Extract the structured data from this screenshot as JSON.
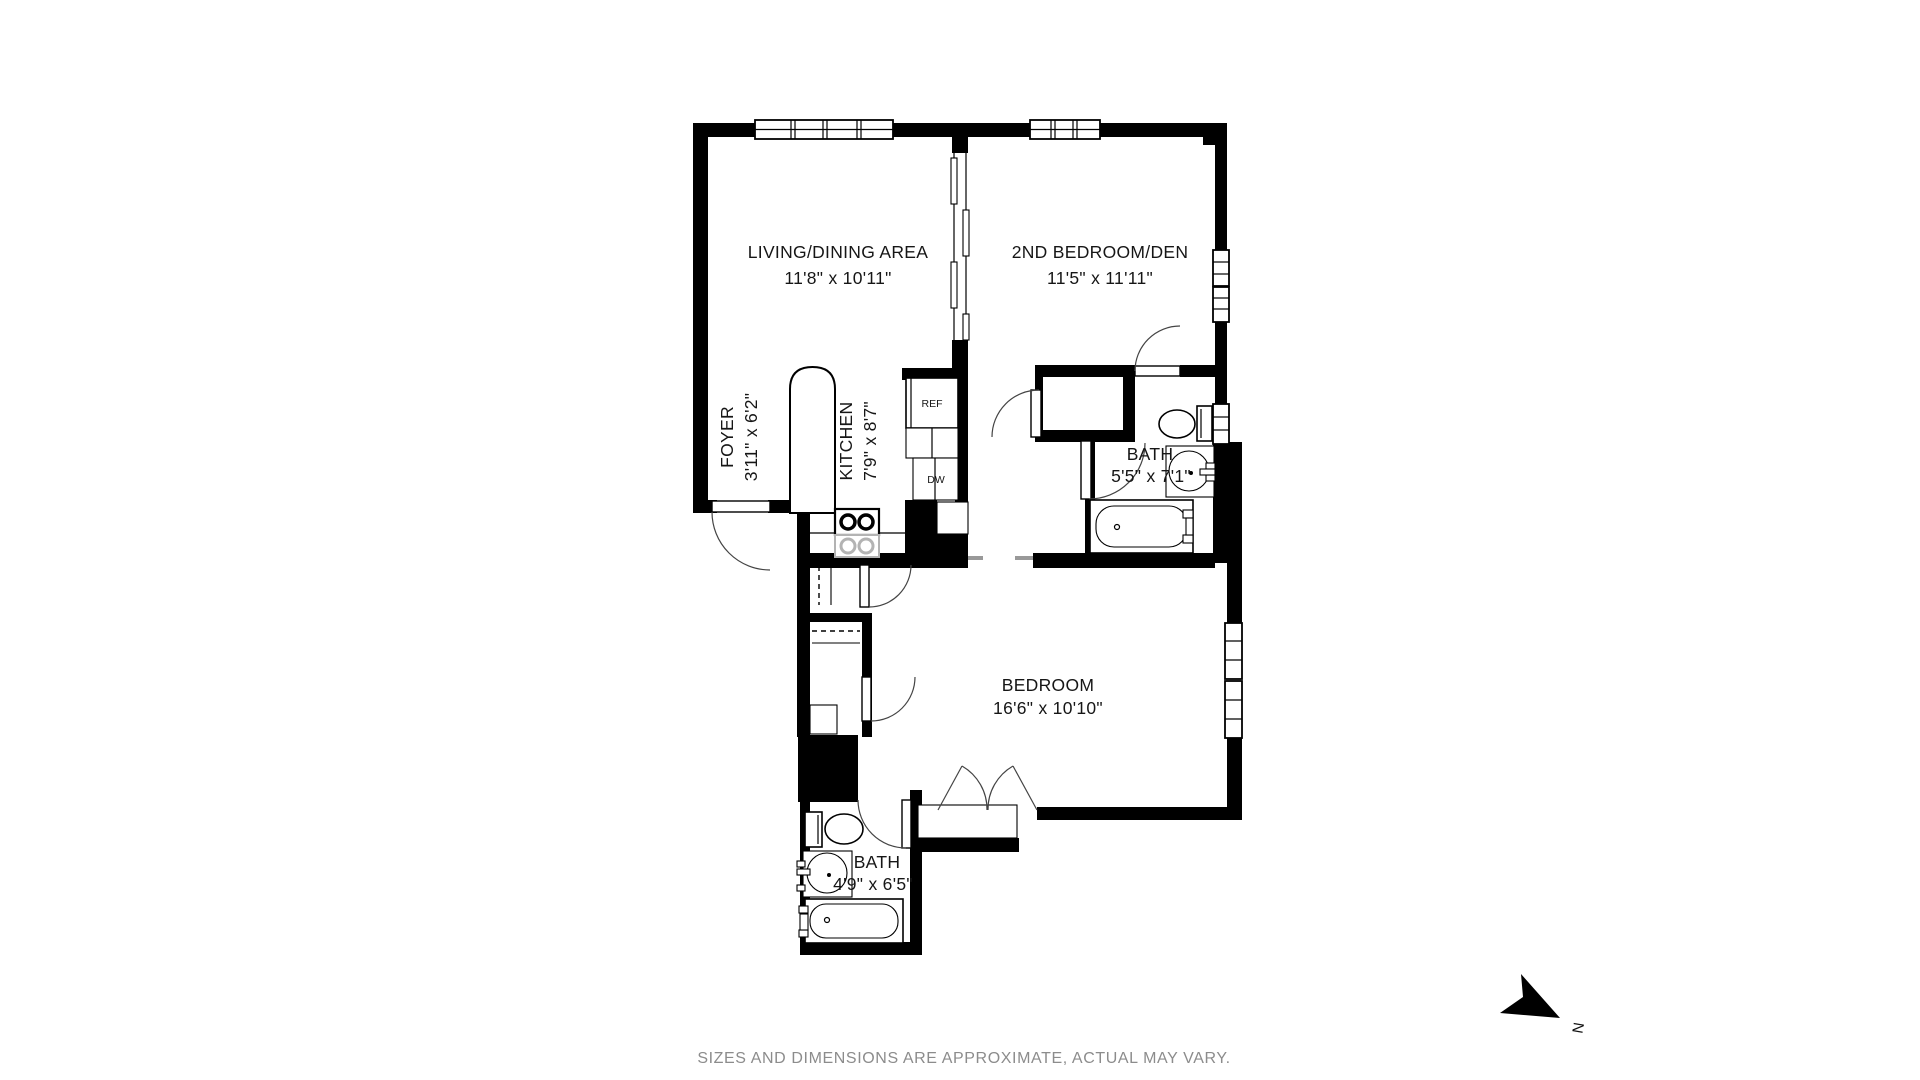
{
  "rooms": {
    "living": {
      "name": "LIVING/DINING AREA",
      "dims": "11'8\" x 10'11\""
    },
    "second_bedroom": {
      "name": "2ND BEDROOM/DEN",
      "dims": "11'5\" x 11'11\""
    },
    "foyer": {
      "name": "FOYER",
      "dims": "3'11\" x 6'2\""
    },
    "kitchen": {
      "name": "KITCHEN",
      "dims": "7'9\" x 8'7\""
    },
    "bath_upper": {
      "name": "BATH",
      "dims": "5'5\" x 7'1\""
    },
    "bedroom": {
      "name": "BEDROOM",
      "dims": "16'6\" x 10'10\""
    },
    "bath_lower": {
      "name": "BATH",
      "dims": "4'9\" x 6'5\""
    }
  },
  "appliances": {
    "refrigerator": "REF",
    "dishwasher": "DW"
  },
  "compass": {
    "north_label": "N"
  },
  "footer": {
    "disclaimer": "SIZES AND DIMENSIONS ARE APPROXIMATE, ACTUAL MAY VARY."
  },
  "colors": {
    "walls": "#000000",
    "footer_text": "#8c8c8c",
    "background": "#ffffff",
    "fixture_gray": "#b3b3b3"
  }
}
